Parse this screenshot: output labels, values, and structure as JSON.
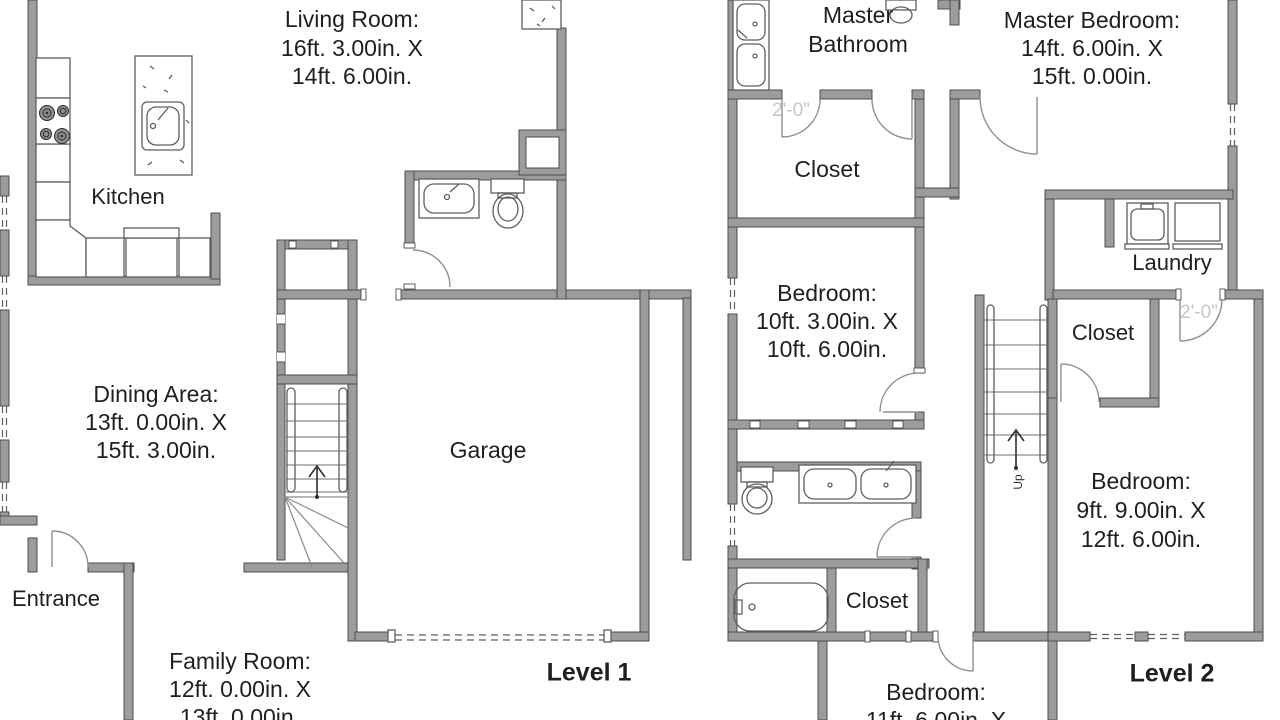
{
  "colors": {
    "wall_fill": "#9c9c9c",
    "wall_edge": "#4e4e4e",
    "text": "#1f1f1f",
    "dim_label": "#c6c6c6"
  },
  "level1": {
    "living_room": {
      "lines": [
        "Living Room:",
        "16ft. 3.00in. X",
        "14ft. 6.00in."
      ]
    },
    "kitchen": {
      "label": "Kitchen"
    },
    "dining_area": {
      "lines": [
        "Dining Area:",
        "13ft. 0.00in. X",
        "15ft. 3.00in."
      ]
    },
    "entrance": {
      "label": "Entrance"
    },
    "family_room": {
      "lines": [
        "Family Room:",
        "12ft. 0.00in. X",
        "13ft. 0.00in."
      ]
    },
    "garage": {
      "label": "Garage"
    },
    "level_label": "Level 1"
  },
  "level2": {
    "master_bathroom": {
      "lines": [
        "Master",
        "Bathroom"
      ]
    },
    "master_bedroom": {
      "lines": [
        "Master Bedroom:",
        "14ft. 6.00in. X",
        "15ft. 0.00in."
      ]
    },
    "walk_in_closet": {
      "label": "Closet"
    },
    "bedroom_middle": {
      "lines": [
        "Bedroom:",
        "10ft. 3.00in. X",
        "10ft. 6.00in."
      ]
    },
    "laundry": {
      "label": "Laundry"
    },
    "closet_middle": {
      "label": "Closet"
    },
    "bedroom_right": {
      "lines": [
        "Bedroom:",
        "9ft. 9.00in. X",
        "12ft. 6.00in."
      ]
    },
    "closet_bottom": {
      "label": "Closet"
    },
    "bedroom_bottom": {
      "lines": [
        "Bedroom:",
        "11ft. 6.00in. X"
      ]
    },
    "stairs": {
      "up_label": "Up"
    },
    "door_width_label": "2'-0\"",
    "level_label": "Level 2"
  }
}
